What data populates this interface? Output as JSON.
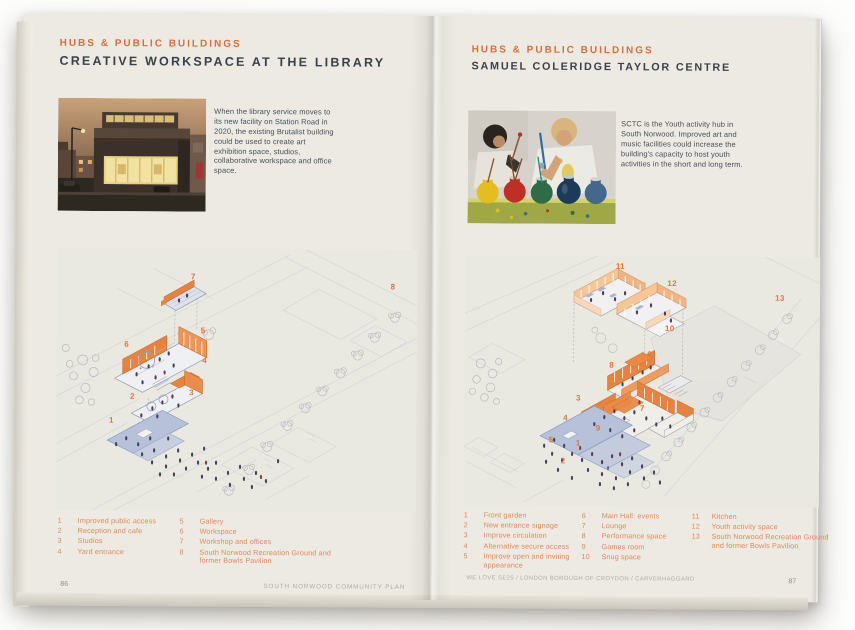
{
  "left_page": {
    "eyebrow": "HUBS & PUBLIC BUILDINGS",
    "title": "CREATIVE WORKSPACE AT THE LIBRARY",
    "body": "When the library service moves to its new facility on Station Road in 2020, the existing Brutalist building could be used to create art exhibition space, studios, collaborative workspace and office space.",
    "legend": [
      {
        "num": "1",
        "label": "Improved public access"
      },
      {
        "num": "2",
        "label": "Reception and cafe"
      },
      {
        "num": "3",
        "label": "Studios"
      },
      {
        "num": "4",
        "label": "Yard entrance"
      },
      {
        "num": "5",
        "label": "Gallery"
      },
      {
        "num": "6",
        "label": "Workspace"
      },
      {
        "num": "7",
        "label": "Workshop and offices"
      },
      {
        "num": "8",
        "label": "South Norwood Recreation Ground and former Bowls Pavilion"
      }
    ],
    "legend_cols": [
      4,
      4
    ],
    "diagram_numbers": [
      {
        "n": "1",
        "x": 15.3,
        "y": 65.6
      },
      {
        "n": "2",
        "x": 21.1,
        "y": 56.5
      },
      {
        "n": "3",
        "x": 37.5,
        "y": 55.0
      },
      {
        "n": "4",
        "x": 41.1,
        "y": 42.7
      },
      {
        "n": "5",
        "x": 40.6,
        "y": 31.3
      },
      {
        "n": "6",
        "x": 19.4,
        "y": 36.6
      },
      {
        "n": "7",
        "x": 37.8,
        "y": 10.7
      },
      {
        "n": "8",
        "x": 93.3,
        "y": 14.1
      }
    ],
    "page_number": "86",
    "footer": "SOUTH NORWOOD COMMUNITY PLAN"
  },
  "right_page": {
    "eyebrow": "HUBS & PUBLIC BUILDINGS",
    "title": "SAMUEL COLERIDGE TAYLOR CENTRE",
    "body": "SCTC is the Youth activity hub in South Norwood. Improved art and music facilities could increase the building's capacity to host youth activities in the short and long term.",
    "legend": [
      {
        "num": "1",
        "label": "Front garden"
      },
      {
        "num": "2",
        "label": "New entrance signage"
      },
      {
        "num": "3",
        "label": "Improve circulation"
      },
      {
        "num": "4",
        "label": "Alternative secure access"
      },
      {
        "num": "5",
        "label": "Improve open and inviting appearance"
      },
      {
        "num": "6",
        "label": "Main Hall: events"
      },
      {
        "num": "7",
        "label": "Lounge"
      },
      {
        "num": "8",
        "label": "Performance space"
      },
      {
        "num": "9",
        "label": "Games room"
      },
      {
        "num": "10",
        "label": "Snug space"
      },
      {
        "num": "11",
        "label": "Kitchen"
      },
      {
        "num": "12",
        "label": "Youth activity space"
      },
      {
        "num": "13",
        "label": "South Norwood Recreation Ground and former Bowls Pavilion"
      }
    ],
    "legend_cols": [
      5,
      5,
      3
    ],
    "diagram_numbers": [
      {
        "n": "1",
        "x": 32.1,
        "y": 74.8
      },
      {
        "n": "2",
        "x": 27.9,
        "y": 82.0
      },
      {
        "n": "3",
        "x": 32.1,
        "y": 56.8
      },
      {
        "n": "4",
        "x": 28.5,
        "y": 64.8
      },
      {
        "n": "5",
        "x": 24.5,
        "y": 73.6
      },
      {
        "n": "6",
        "x": 52.1,
        "y": 39.2
      },
      {
        "n": "7",
        "x": 50.1,
        "y": 60.8
      },
      {
        "n": "8",
        "x": 41.4,
        "y": 43.6
      },
      {
        "n": "9",
        "x": 37.7,
        "y": 68.8
      },
      {
        "n": "10",
        "x": 57.7,
        "y": 28.8
      },
      {
        "n": "11",
        "x": 43.7,
        "y": 4.0
      },
      {
        "n": "12",
        "x": 58.3,
        "y": 10.8
      },
      {
        "n": "13",
        "x": 88.7,
        "y": 16.4
      }
    ],
    "page_number": "87",
    "footer": "WE LOVE SE25 / LONDON BOROUGH OF CROYDON / CARVERHAGGARD"
  },
  "colors": {
    "accent_orange": "#D96F3B",
    "legend_orange": "#E2885A",
    "ink": "#3A414B",
    "body_ink": "#474E57",
    "footer_grey": "#ACAEA7",
    "page_bg": "#ECEAE3",
    "wall_orange": "#E8823F",
    "deck_blue": "#B7C2DA",
    "figure_purple": "#4E3E5C"
  }
}
